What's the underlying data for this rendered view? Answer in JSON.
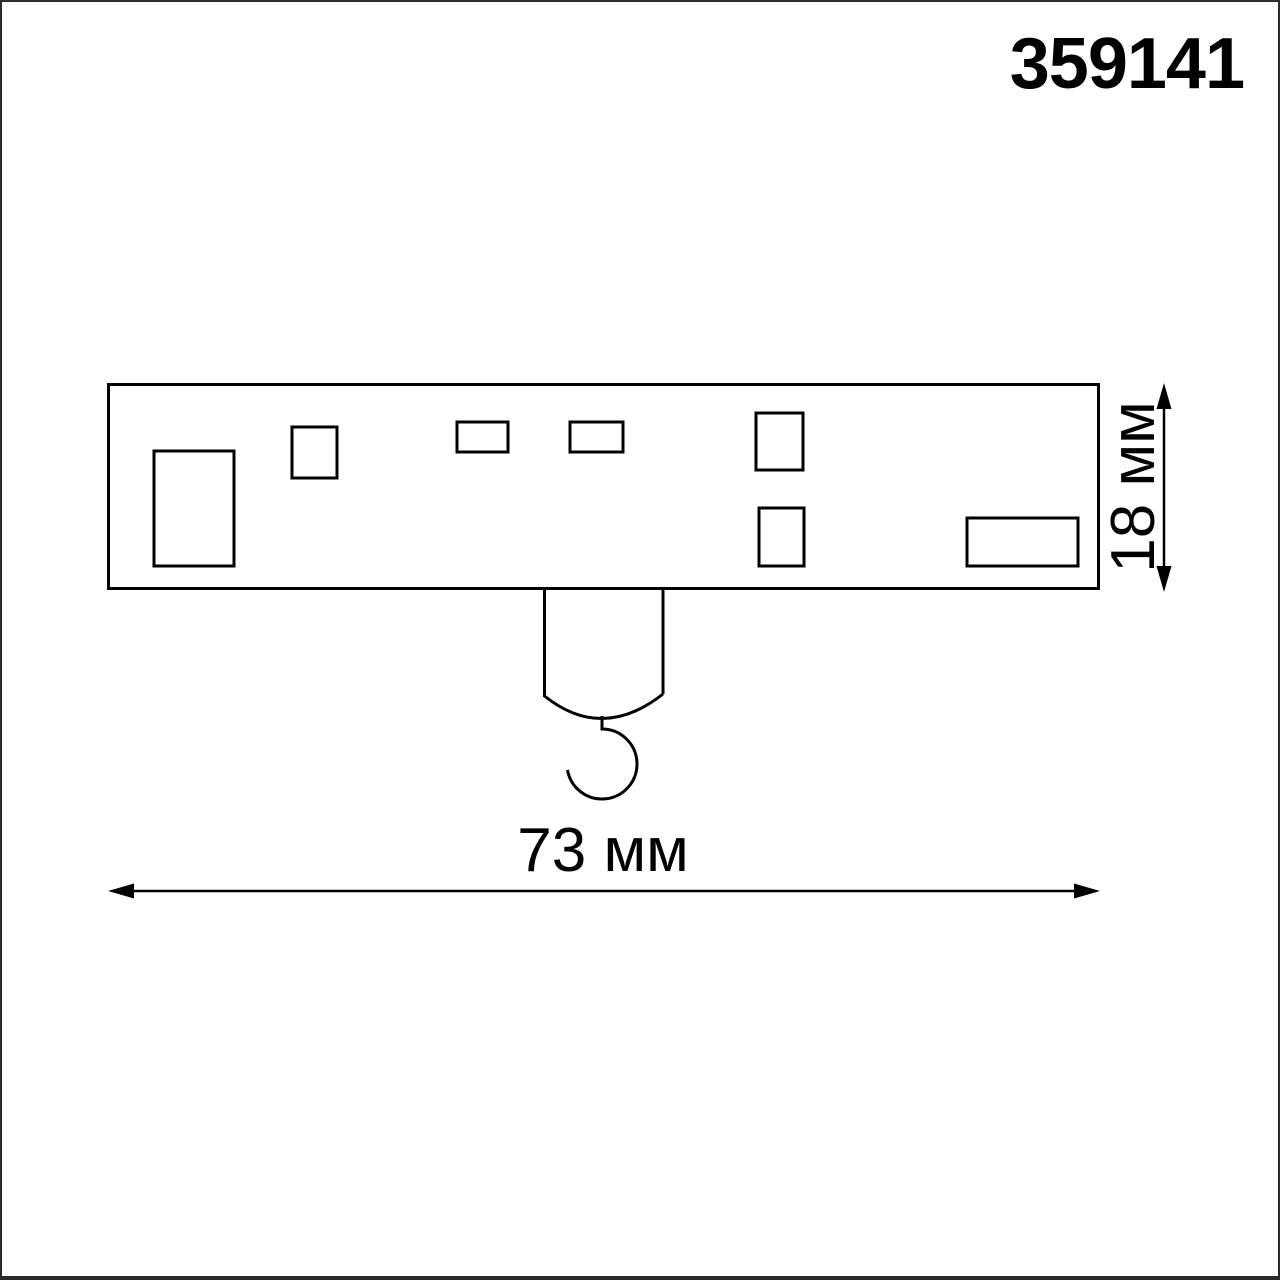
{
  "article_number": "359141",
  "drawing": {
    "type": "technical-dimension-drawing",
    "view": "side view of track adapter with suspension hook",
    "width_dimension": "73 мм",
    "height_dimension": "18 мм"
  },
  "colors": {
    "line": "#000000",
    "frame": "#2b2b2b",
    "background": "#ffffff",
    "text": "#000000"
  }
}
